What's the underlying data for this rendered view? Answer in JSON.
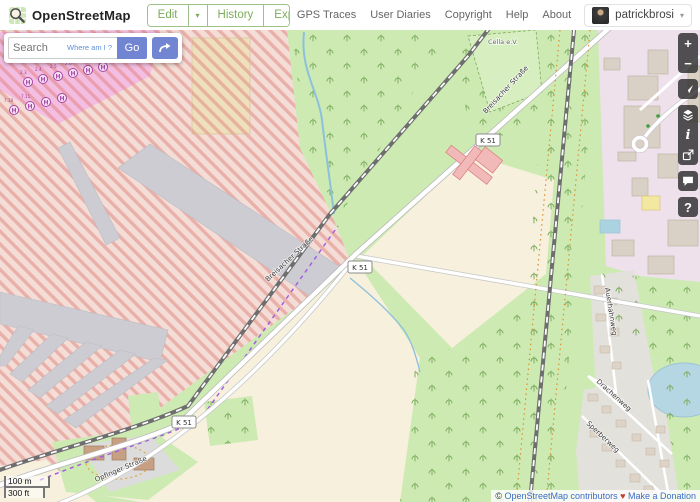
{
  "header": {
    "title": "OpenStreetMap",
    "nav": {
      "edit": "Edit",
      "history": "History",
      "export": "Export"
    },
    "caret": "▾",
    "links": [
      "GPS Traces",
      "User Diaries",
      "Copyright",
      "Help",
      "About"
    ],
    "username": "patrickbrosi"
  },
  "search": {
    "placeholder": "Search",
    "where_am_i": "Where am I ?",
    "go": "Go"
  },
  "controls": {
    "zoom_in": "+",
    "zoom_out": "−",
    "info": "i",
    "query": "?"
  },
  "map": {
    "road_ref": "K 51",
    "main_road_label": "Breisacher Straße",
    "labels": {
      "club": "Cella e.V.",
      "drachenweg": "Drachenweg",
      "sperberweg": "Sperberweg",
      "auerhahnweg": "Auerhahnweg",
      "opfinger": "Opfinger Straße"
    },
    "helipad_letter": "H",
    "helipad_refs": [
      "2.3",
      "2.4",
      "2.5",
      "2.6",
      "2.9",
      "4.2",
      "7.10",
      "7.11"
    ],
    "scale_metric": "100 m",
    "scale_imperial": "300 ft",
    "attribution": {
      "prefix": "©",
      "osm_link": "OpenStreetMap contributors",
      "heart": "♥",
      "donate_link": "Make a Donation"
    }
  },
  "colors": {
    "brand_green": "#7cab5a",
    "button_blue": "#7285d2",
    "control_bg": "#2d2d2d",
    "attribution_link_blue": "#3c6cc4",
    "heart_red": "#c43c35",
    "forest_green": "#cdeab3",
    "danger_hatch_red": "#e28a84",
    "industrial_lavender": "#eee1ec"
  }
}
